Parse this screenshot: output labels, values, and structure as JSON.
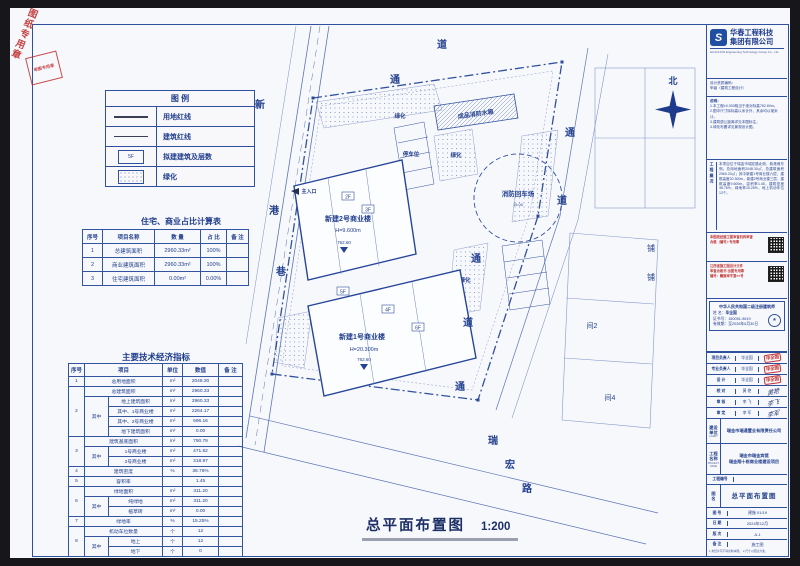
{
  "stamps": {
    "corner_diag": "图纸专用章",
    "corner_box": "审图专用章"
  },
  "sheet_title": {
    "text": "总平面布置图",
    "scale": "1:200"
  },
  "legend": {
    "title": "图  例",
    "items": [
      {
        "symbol": "thick-line",
        "label": "用地红线"
      },
      {
        "symbol": "thin-line",
        "label": "建筑红线"
      },
      {
        "symbol": "rect-floors",
        "symbol_text": "5F",
        "label": "拟建建筑及层数"
      },
      {
        "symbol": "dot-hatch",
        "label": "绿化"
      }
    ]
  },
  "ratio_table": {
    "title": "住宅、商业占比计算表",
    "colw": [
      20,
      52,
      46,
      26,
      22
    ],
    "headers": [
      "序号",
      "项目名称",
      "数 量",
      "占 比",
      "备 注"
    ],
    "rows": [
      [
        "1",
        "总建筑面积",
        "2960.33m²",
        "100%",
        ""
      ],
      [
        "2",
        "商业建筑面积",
        "2960.33m²",
        "100%",
        ""
      ],
      [
        "3",
        "住宅建筑面积",
        "0.00m²",
        "0.00%",
        ""
      ]
    ]
  },
  "indicator_table": {
    "title": "主要技术经济指标",
    "colw": [
      16,
      24,
      54,
      20,
      36,
      24
    ],
    "headers": [
      {
        "t": "序号"
      },
      {
        "t": "项目",
        "cs": 2
      },
      {
        "t": "单位"
      },
      {
        "t": "数值"
      },
      {
        "t": "备 注"
      }
    ],
    "rows": [
      [
        "1",
        {
          "t": "总用地面积",
          "cs": 2
        },
        "m²",
        "2048.30",
        ""
      ],
      [
        {
          "t": "2",
          "rs": 5
        },
        {
          "t": "总建筑面积",
          "cs": 2
        },
        "m²",
        "2960.33",
        ""
      ],
      [
        {
          "t": "其中",
          "rs": 4
        },
        "地上建筑面积",
        "m²",
        "2960.33",
        ""
      ],
      [
        "其中、1号商业楼",
        "m²",
        "2264.17",
        ""
      ],
      [
        "其中、2号商业楼",
        "m²",
        "696.16",
        ""
      ],
      [
        "地下建筑面积",
        "m²",
        "0.00",
        ""
      ],
      [
        {
          "t": "3",
          "rs": 3
        },
        {
          "t": "建筑基底面积",
          "cs": 2
        },
        "m²",
        "790.79",
        ""
      ],
      [
        {
          "t": "其中",
          "rs": 2
        },
        "1号商业楼",
        "m²",
        "471.82",
        ""
      ],
      [
        "2号商业楼",
        "m²",
        "318.97",
        ""
      ],
      [
        "4",
        {
          "t": "建筑密度",
          "cs": 2
        },
        "%",
        "38.76%",
        ""
      ],
      [
        "5",
        {
          "t": "容积率",
          "cs": 2
        },
        "",
        "1.45",
        ""
      ],
      [
        {
          "t": "6",
          "rs": 3
        },
        {
          "t": "绿地面积",
          "cs": 2
        },
        "m²",
        "311.20",
        ""
      ],
      [
        {
          "t": "其中",
          "rs": 2
        },
        "纯绿地",
        "m²",
        "311.20",
        ""
      ],
      [
        "植草砖",
        "m²",
        "0.00",
        ""
      ],
      [
        "7",
        {
          "t": "绿地率",
          "cs": 2
        },
        "%",
        "15.25%",
        ""
      ],
      [
        {
          "t": "8",
          "rs": 3
        },
        {
          "t": "机动车位数量",
          "cs": 2
        },
        "个",
        "12",
        ""
      ],
      [
        {
          "t": "其中",
          "rs": 2
        },
        "地上",
        "个",
        "12",
        ""
      ],
      [
        "地下",
        "个",
        "0",
        ""
      ]
    ]
  },
  "plan": {
    "b2_name": "新建2号商业楼",
    "b2_h": "H=9.600m",
    "b2_elev": "762.60",
    "b1_name": "新建1号商业楼",
    "b1_h": "H=20.300m",
    "b1_elev": "762.60",
    "fire_circle": "消防回车场",
    "fire_dim": "15.00",
    "tank": "成品消防水箱",
    "parking": "停车位",
    "entrance": "主入口",
    "greens": [
      "绿化",
      "绿化",
      "绿化"
    ],
    "tags": [
      "2F",
      "3F",
      "5F",
      "4F",
      "6F"
    ],
    "road_left": [
      "新",
      "港",
      "巷"
    ],
    "road_tr": [
      "通",
      "道"
    ],
    "road_right": [
      "通",
      "道",
      "通",
      "道",
      "通"
    ],
    "road_bottom": [
      "瑞",
      "宏",
      "路"
    ],
    "north": "北",
    "neighbors": [
      "铺",
      "铺",
      "间2",
      "间4"
    ]
  },
  "titleblock": {
    "company": {
      "name1": "华春工程科技",
      "name2": "集团有限公司",
      "name_en": "HUACHUN Engineering Technology Group Co., Ltd",
      "qual1": "设计资质编码：",
      "qual2": "甲级（建筑工程设计）"
    },
    "notes1_title": "说明：",
    "notes1": [
      "1.本工程±0.000相当于绝对标高762.60m。",
      "2.图中尺寸除标高以米计外，其余均以毫米计。",
      "3.建筑退让距离详见本图标注。",
      "4.绿化布置详见景观设计图。"
    ],
    "notes2_side": "工程概况",
    "notes2_text": "本项目位于瑞金市瑞宏路北侧、新港巷东侧。总用地面积2048.30㎡，总建筑面积2960.33㎡；其中新建1号商业楼六层、建筑高度20.300m，新建2号商业楼三层、建筑高度9.600m。容积率1.45，建筑密度38.76%，绿地率15.25%，地上机动车位12个。",
    "stampA": [
      "本图纸经施工图审查机构审查",
      "合格（编号）·专用章"
    ],
    "stampB": [
      "江西省施工图设计文件",
      "审查合格书·出图专用章",
      "编号：赣施审字第××号"
    ],
    "arch": {
      "title": "中华人民共和国二级注册建筑师",
      "name_label": "姓 名：",
      "name": "毕全国",
      "cert_label": "证书号：",
      "cert": "150051-9619",
      "valid_label": "有效期：",
      "valid": "至2026年6月30日"
    },
    "sig": [
      {
        "label": "项目负责人",
        "name": "毕全国",
        "sig": "毕全国"
      },
      {
        "label": "专业负责人",
        "name": "毕全国",
        "sig": "毕全国"
      },
      {
        "label": "设  计",
        "name": "毕全国",
        "sig": "毕全国"
      },
      {
        "label": "校  对",
        "name": "黄 艳",
        "sig": "黄艳"
      },
      {
        "label": "审  核",
        "name": "李 飞",
        "sig": "李飞"
      },
      {
        "label": "审  定",
        "name": "李 军",
        "sig": "李军"
      }
    ],
    "client": {
      "side": "建设单位",
      "side_en": "CLIENT",
      "value": "瑞金市瑞通置业有限责任公司"
    },
    "project": {
      "side": "工程名称",
      "side_en": "PROJECT NAME",
      "line1": "瑞金市瑞金宾馆",
      "line2": "瑞金翔十栋商业楼建设项目"
    },
    "projno_label": "工程编号",
    "figure": {
      "side": "图 名",
      "value": "总平面布置图"
    },
    "rows": [
      {
        "label": "图 号",
        "value": "建施 01/19"
      },
      {
        "label": "日 期",
        "value": "2024年12月"
      },
      {
        "label": "版 次",
        "value": "A-1"
      },
      {
        "label": "备 注",
        "value": "施工图"
      }
    ],
    "footer1": "1.未经许可不得复制本图。",
    "footer2": "2.尺寸以图注为准。"
  }
}
